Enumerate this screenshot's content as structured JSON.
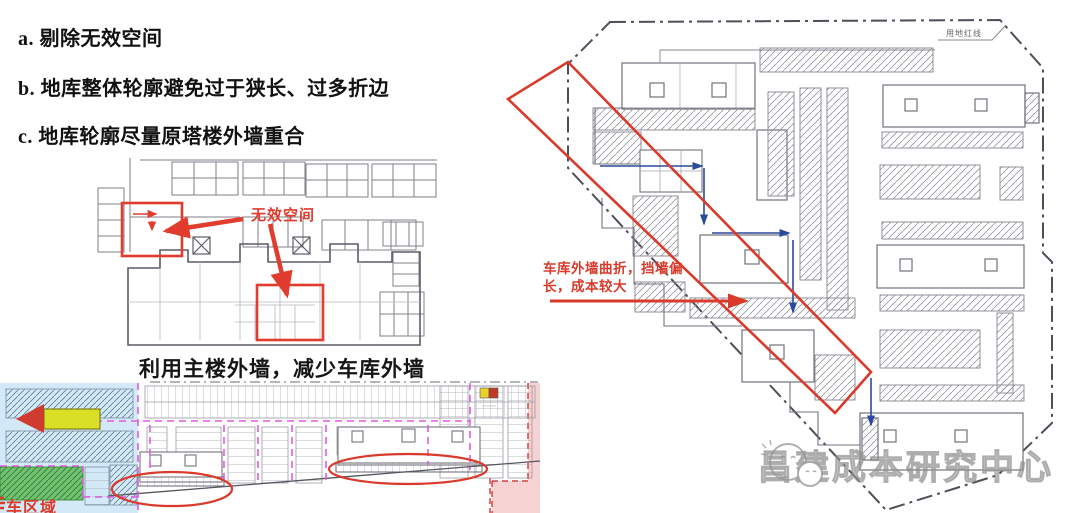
{
  "notes": {
    "item_a": "a. 剔除无效空间",
    "item_b": "b. 地库整体轮廓避免过于狭长、过多折边",
    "item_c": "c. 地库轮廓尽量原塔楼外墙重合"
  },
  "plan_invalid_space": {
    "annotation": "无效空间",
    "caption": "利用主楼外墙，减少车库外墙"
  },
  "plan_colored": {
    "corner_label": "车区域"
  },
  "plan_site": {
    "boundary_label": "用地红线",
    "annotation": "车库外墙曲折，挡墙偏长，成本较大"
  },
  "watermark": {
    "text": "昌建成本研究中心"
  },
  "colors": {
    "annotation_red": "#d93a2b",
    "arrow_blue": "#2b4a9b",
    "magenta_dash": "#e25ae2",
    "light_blue": "#d3e9f7",
    "green_zone": "#71c171",
    "pink_zone": "#f2b4b4",
    "yellow_arrow": "#d9df25",
    "plan_line_gray": "#72737c"
  }
}
